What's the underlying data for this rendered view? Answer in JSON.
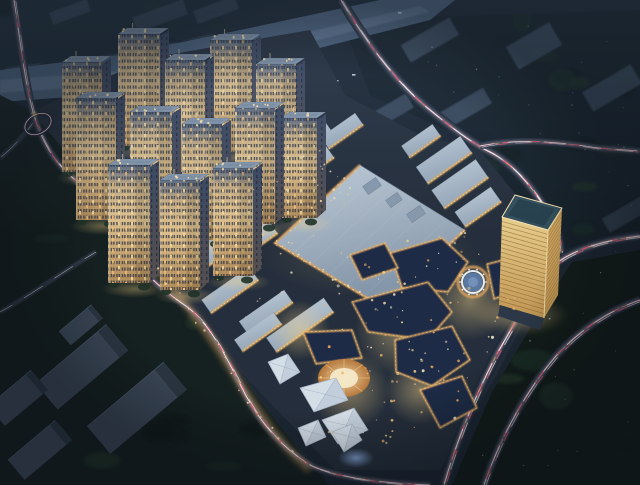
{
  "meta": {
    "description": "Night-time aerial architectural rendering of a mixed-use development with residential towers, shopping mall, commercial strips, office tower, entertainment plazas, roads with light trails, and a river",
    "width": 640,
    "height": 485
  },
  "palette": {
    "bg": "#1b2531",
    "siteBase": "#242d3a",
    "river": "#4e647f",
    "riverHi": "#7e94b2",
    "slabFaint": "#3d4d63",
    "bgBld": "#46586e",
    "whRoof": "#3b4757",
    "whSide": "#28333f",
    "stripRoofA": "#ccd7e1",
    "stripRoofB": "#96a8ba",
    "stripEdge": "#eeb25e",
    "stripGlow": "#ffdf9f",
    "mallA": "#c3cfda",
    "mallB": "#7f92a7",
    "mallSeam": "rgba(255,255,255,0.07)",
    "mallEdge": "#eba95c",
    "mallEdgeHi": "#ffdf9f",
    "mallBox": "#8b9cb0",
    "towerTop": "#8ea0b5",
    "towerRoofIn": "#76879c",
    "towerFace0": "#5d6c85",
    "towerFace1": "#cdb286",
    "towerFace2": "#e6c792",
    "towerFace3": "#b8905a",
    "towerSideA": "#3a4660",
    "towerSideB": "#585150",
    "towerWin": "#2a3040",
    "towerLitA": "#ffdf9f",
    "towerLitB": "#ffc878",
    "crown": "#ffe6ad",
    "shrub": "#1e3123",
    "goldA": "#f2d58f",
    "goldB": "#c89a52",
    "goldDark": "#d9ae62",
    "goldTop": "#33505c",
    "goldTopIn": "#27404d",
    "goldEdge": "#ffe9b4",
    "goldFloor": "#7c5526",
    "entRoof": "#1f2c44",
    "entEdge": "#f0b565",
    "entEdgeHi": "#ffe1a3",
    "tent": "#dde6ef",
    "tentLine": "#aebdcc",
    "plazaDisk": "#5b7ba6",
    "plazaDiskHi": "#7e9cc4",
    "ringWhite": "#f2f6fa",
    "ringGold": "#e8a95e",
    "stageA": "#ffe2a8",
    "stageB": "#c27c3a",
    "stageCore": "#fff2d0",
    "glowWarm": "#ffd98a",
    "glowBlue": "#9fc4ff",
    "roadBase": "#1c2836",
    "trailPink": "#ffd7e2",
    "trailRed": "#ff5f7d",
    "trailWhite": "#ffffff",
    "trailOrange": "#ffb26b",
    "trailCyan": "#bfe3ff",
    "hazeTop": "rgba(126,156,196,0.16)",
    "vignette": "rgba(6,10,16,0.40)",
    "blobA": "#1d3026",
    "blobB": "#0d1714",
    "blobC": "#223528"
  },
  "scene": {
    "river": {
      "poly": [
        [
          0,
          70
        ],
        [
          120,
          55
        ],
        [
          250,
          28
        ],
        [
          380,
          0
        ],
        [
          455,
          0
        ],
        [
          430,
          20
        ],
        [
          280,
          58
        ],
        [
          140,
          92
        ],
        [
          0,
          102
        ]
      ],
      "hi": [
        [
          0,
          80
        ],
        [
          140,
          70
        ],
        [
          300,
          34
        ],
        [
          420,
          6
        ],
        [
          430,
          12
        ],
        [
          290,
          47
        ],
        [
          150,
          82
        ],
        [
          0,
          93
        ]
      ],
      "boats": [
        [
          335,
          80
        ],
        [
          352,
          74
        ],
        [
          398,
          12
        ]
      ]
    },
    "slabsTL": [
      [
        6,
        0,
        36,
        72
      ],
      [
        50,
        0,
        30,
        60
      ],
      [
        88,
        0,
        46,
        66
      ],
      [
        140,
        0,
        36,
        50
      ],
      [
        182,
        0,
        30,
        40
      ]
    ],
    "topSlabs": [
      [
        160,
        16,
        54,
        16
      ],
      [
        216,
        10,
        44,
        14
      ],
      [
        70,
        12,
        40,
        13
      ]
    ],
    "bgSlabs": [
      [
        430,
        40,
        56,
        20,
        0.75
      ],
      [
        534,
        46,
        50,
        26,
        0.75
      ],
      [
        390,
        112,
        46,
        16,
        0.7
      ],
      [
        466,
        108,
        50,
        18,
        0.7
      ],
      [
        612,
        88,
        56,
        22,
        0.7
      ],
      [
        625,
        215,
        44,
        16,
        0.5
      ],
      [
        600,
        320,
        40,
        14,
        0.35
      ]
    ],
    "sitePoly": [
      [
        30,
        112
      ],
      [
        150,
        58
      ],
      [
        310,
        30
      ],
      [
        345,
        95
      ],
      [
        420,
        135
      ],
      [
        480,
        150
      ],
      [
        560,
        250
      ],
      [
        498,
        372
      ],
      [
        440,
        470
      ],
      [
        335,
        470
      ],
      [
        248,
        380
      ],
      [
        150,
        262
      ],
      [
        54,
        140
      ]
    ],
    "trees": [
      {
        "name": "trees-left",
        "poly": [
          [
            0,
            95
          ],
          [
            30,
            110
          ],
          [
            60,
            145
          ],
          [
            105,
            208
          ],
          [
            152,
            264
          ],
          [
            208,
            332
          ],
          [
            258,
            398
          ],
          [
            305,
            458
          ],
          [
            330,
            485
          ],
          [
            0,
            485
          ]
        ],
        "fill": "#131e1d",
        "blobs": 14,
        "seed": 3
      },
      {
        "name": "trees-right",
        "poly": [
          [
            572,
            262
          ],
          [
            640,
            250
          ],
          [
            640,
            485
          ],
          [
            452,
            485
          ],
          [
            492,
            392
          ],
          [
            538,
            315
          ]
        ],
        "fill": "#111b17",
        "blobs": 10,
        "seed": 7
      },
      {
        "name": "trees-top-band",
        "poly": [
          [
            0,
            0
          ],
          [
            380,
            0
          ],
          [
            250,
            26
          ],
          [
            120,
            53
          ],
          [
            0,
            68
          ]
        ],
        "fill": "#1a2731",
        "blobs": 6,
        "seed": 13
      },
      {
        "name": "trees-northeast",
        "poly": [
          [
            342,
            20
          ],
          [
            640,
            10
          ],
          [
            640,
            242
          ],
          [
            562,
            248
          ],
          [
            468,
            140
          ],
          [
            370,
            95
          ]
        ],
        "fill": "#152028",
        "blobs": 16,
        "seed": 17
      },
      {
        "name": "trees-site-pocket",
        "poly": [
          [
            310,
            40
          ],
          [
            345,
            95
          ],
          [
            420,
            135
          ],
          [
            330,
            135
          ],
          [
            290,
            80
          ]
        ],
        "fill": "#16241f",
        "blobs": 5,
        "seed": 19
      }
    ],
    "roads": [
      {
        "name": "ramp-branch",
        "d": "M35,120 C24,136 12,148 0,158",
        "bw": 5,
        "k": 0.5,
        "faint": true
      },
      {
        "name": "west-spur",
        "d": "M0,312 C30,296 62,272 96,252",
        "bw": 5,
        "k": 0.45,
        "faint": true
      },
      {
        "name": "left-road",
        "d": "M14,0 C20,38 24,78 33,112 C44,150 60,168 80,184 C100,200 112,222 122,240 C140,272 165,292 186,306 C208,322 224,352 242,388 C262,428 288,452 312,466 C340,478 380,483 430,485",
        "bw": 8,
        "k": 0.8,
        "glow": "M150,262 C175,292 200,318 235,375 C258,414 285,450 310,470"
      },
      {
        "name": "north-avenue",
        "d": "M341,0 C365,40 395,82 430,110 C452,128 468,140 486,150 C512,162 532,186 549,214 C556,226 560,240 561,254",
        "bw": 10,
        "k": 1
      },
      {
        "name": "east-branch",
        "d": "M480,146 C520,138 560,142 598,148 L640,151",
        "bw": 7,
        "k": 0.7
      },
      {
        "name": "ring-road-inner",
        "d": "M640,236 C606,240 578,248 558,262 C532,288 518,318 498,352 C478,390 458,436 444,485",
        "bw": 11,
        "k": 1
      },
      {
        "name": "ring-road-outer",
        "d": "M640,300 C606,312 580,330 556,356 C530,386 502,432 484,485",
        "bw": 9,
        "k": 0.85
      }
    ],
    "loop": {
      "cx": 38,
      "cy": 124,
      "rx": 14,
      "ry": 9.5,
      "rot": -28
    },
    "warehouses": {
      "rot": -40,
      "items": [
        [
          81,
          325,
          42,
          18
        ],
        [
          82,
          367,
          92,
          34
        ],
        [
          18,
          398,
          56,
          26
        ],
        [
          137,
          408,
          100,
          36
        ],
        [
          40,
          450,
          62,
          26
        ]
      ]
    },
    "strips": {
      "rot": -35,
      "items": [
        [
          299,
          149,
          74,
          18
        ],
        [
          342,
          131,
          42,
          14
        ],
        [
          256,
          184,
          68,
          17
        ],
        [
          306,
          168,
          58,
          15
        ],
        [
          230,
          220,
          70,
          17
        ],
        [
          278,
          205,
          52,
          15
        ],
        [
          205,
          258,
          72,
          17
        ],
        [
          252,
          242,
          52,
          15
        ],
        [
          230,
          290,
          58,
          16
        ],
        [
          266,
          312,
          55,
          15
        ],
        [
          300,
          325,
          70,
          17
        ],
        [
          258,
          332,
          48,
          14
        ]
      ]
    },
    "neBlocks": {
      "rot": -35,
      "items": [
        [
          444,
          160,
          54,
          20
        ],
        [
          460,
          184,
          54,
          22
        ],
        [
          478,
          207,
          44,
          18
        ],
        [
          421,
          141,
          38,
          14
        ]
      ]
    },
    "mall": {
      "quad": [
        [
          275,
          243
        ],
        [
          360,
          165
        ],
        [
          465,
          230
        ],
        [
          382,
          307
        ]
      ],
      "seams": 5,
      "boxes": [
        [
          372,
          186,
          16,
          10
        ],
        [
          394,
          200,
          14,
          9
        ],
        [
          416,
          214,
          16,
          10
        ]
      ],
      "boxRot": -35
    },
    "entertainment": {
      "glows": [
        [
          470,
          300,
          40
        ],
        [
          400,
          330,
          45
        ],
        [
          350,
          390,
          40
        ],
        [
          420,
          390,
          35
        ],
        [
          300,
          330,
          30
        ]
      ],
      "roofs": [
        [
          [
            390,
            253
          ],
          [
            442,
            238
          ],
          [
            468,
            262
          ],
          [
            448,
            292
          ],
          [
            402,
            288
          ]
        ],
        [
          [
            352,
            302
          ],
          [
            428,
            282
          ],
          [
            452,
            312
          ],
          [
            428,
            340
          ],
          [
            368,
            332
          ]
        ],
        [
          [
            395,
            340
          ],
          [
            452,
            326
          ],
          [
            470,
            360
          ],
          [
            432,
            386
          ],
          [
            396,
            372
          ]
        ],
        [
          [
            303,
            332
          ],
          [
            352,
            330
          ],
          [
            362,
            358
          ],
          [
            316,
            364
          ]
        ],
        [
          [
            420,
            390
          ],
          [
            462,
            376
          ],
          [
            477,
            408
          ],
          [
            440,
            428
          ]
        ],
        [
          [
            487,
            264
          ],
          [
            515,
            257
          ],
          [
            523,
            289
          ],
          [
            494,
            299
          ]
        ],
        [
          [
            350,
            255
          ],
          [
            385,
            243
          ],
          [
            398,
            268
          ],
          [
            362,
            280
          ]
        ]
      ],
      "circle": {
        "cx": 473,
        "cy": 282,
        "rOut": 15,
        "rRing": 11,
        "rDisk": 9.5,
        "rCore": 5,
        "dots": 10,
        "rDots": 13
      },
      "stage": {
        "cx": 344,
        "cy": 378,
        "rx": 26,
        "ry": 19,
        "coreRx": 14,
        "coreRy": 10,
        "rays": 8
      },
      "tents": [
        [
          [
            268,
            362
          ],
          [
            288,
            354
          ],
          [
            300,
            372
          ],
          [
            280,
            384
          ]
        ],
        [
          [
            300,
            388
          ],
          [
            336,
            378
          ],
          [
            348,
            400
          ],
          [
            314,
            412
          ]
        ],
        [
          [
            322,
            420
          ],
          [
            354,
            408
          ],
          [
            368,
            430
          ],
          [
            338,
            444
          ]
        ],
        [
          [
            298,
            428
          ],
          [
            318,
            420
          ],
          [
            326,
            437
          ],
          [
            306,
            446
          ]
        ],
        [
          [
            332,
            432
          ],
          [
            352,
            424
          ],
          [
            362,
            440
          ],
          [
            344,
            452
          ]
        ]
      ],
      "canopy": {
        "cx": 356,
        "cy": 458,
        "rx": 18,
        "ry": 10
      }
    },
    "goldenTower": {
      "top": [
        [
          515,
          195
        ],
        [
          562,
          208
        ],
        [
          548,
          230
        ],
        [
          502,
          217
        ]
      ],
      "topIn": [
        [
          519,
          199
        ],
        [
          555,
          209
        ],
        [
          544,
          226
        ],
        [
          508,
          215
        ]
      ],
      "left": [
        [
          502,
          217
        ],
        [
          548,
          230
        ],
        [
          544,
          318
        ],
        [
          499,
          305
        ]
      ],
      "right": [
        [
          548,
          230
        ],
        [
          562,
          208
        ],
        [
          558,
          295
        ],
        [
          544,
          318
        ]
      ],
      "deck": [
        [
          500,
          305
        ],
        [
          544,
          318
        ],
        [
          540,
          330
        ],
        [
          498,
          316
        ]
      ],
      "glow": {
        "cx": 520,
        "cy": 315,
        "rx": 48,
        "ry": 20
      },
      "floors": 20
    },
    "towers": [
      [
        62,
        62,
        40,
        110
      ],
      [
        118,
        34,
        42,
        112
      ],
      [
        76,
        98,
        40,
        122
      ],
      [
        165,
        60,
        40,
        112
      ],
      [
        210,
        40,
        42,
        112
      ],
      [
        256,
        64,
        40,
        110
      ],
      [
        130,
        112,
        42,
        120
      ],
      [
        182,
        124,
        40,
        116
      ],
      [
        235,
        108,
        40,
        116
      ],
      [
        281,
        118,
        36,
        100
      ],
      [
        108,
        165,
        42,
        118
      ],
      [
        160,
        180,
        40,
        110
      ],
      [
        213,
        168,
        40,
        108
      ]
    ],
    "scatters": [
      {
        "name": "entertainment-lights",
        "poly": [
          [
            340,
            250
          ],
          [
            470,
            232
          ],
          [
            520,
            300
          ],
          [
            448,
            440
          ],
          [
            335,
            455
          ],
          [
            300,
            370
          ]
        ],
        "n": 110,
        "colors": [
          "#ffd98c",
          "#ffeccb",
          "#ffb566"
        ],
        "rMin": 0.6,
        "rMax": 1.6,
        "seed": 11,
        "o": 0.9
      },
      {
        "name": "commercial-lights",
        "poly": [
          [
            190,
            245
          ],
          [
            300,
            140
          ],
          [
            365,
            175
          ],
          [
            255,
            335
          ]
        ],
        "n": 55,
        "colors": [
          "#ffd08a",
          "#fff1cd"
        ],
        "rMin": 0.5,
        "rMax": 1.2,
        "seed": 23,
        "o": 0.85
      },
      {
        "name": "roadside-lamps-se",
        "poly": [
          [
            560,
            255
          ],
          [
            640,
            248
          ],
          [
            640,
            470
          ],
          [
            470,
            470
          ]
        ],
        "n": 16,
        "colors": [
          "#cfe2ff",
          "#ffd9a0"
        ],
        "rMin": 0.4,
        "rMax": 0.9,
        "seed": 51,
        "o": 0.6
      },
      {
        "name": "far-city-lamps",
        "poly": [
          [
            380,
            20
          ],
          [
            640,
            14
          ],
          [
            640,
            230
          ],
          [
            480,
            140
          ]
        ],
        "n": 22,
        "colors": [
          "#cfe2ff",
          "#ffedc2"
        ],
        "rMin": 0.4,
        "rMax": 0.9,
        "seed": 61,
        "o": 0.5
      }
    ],
    "mallEdgeDots": 24,
    "r5SideDots": 16
  }
}
